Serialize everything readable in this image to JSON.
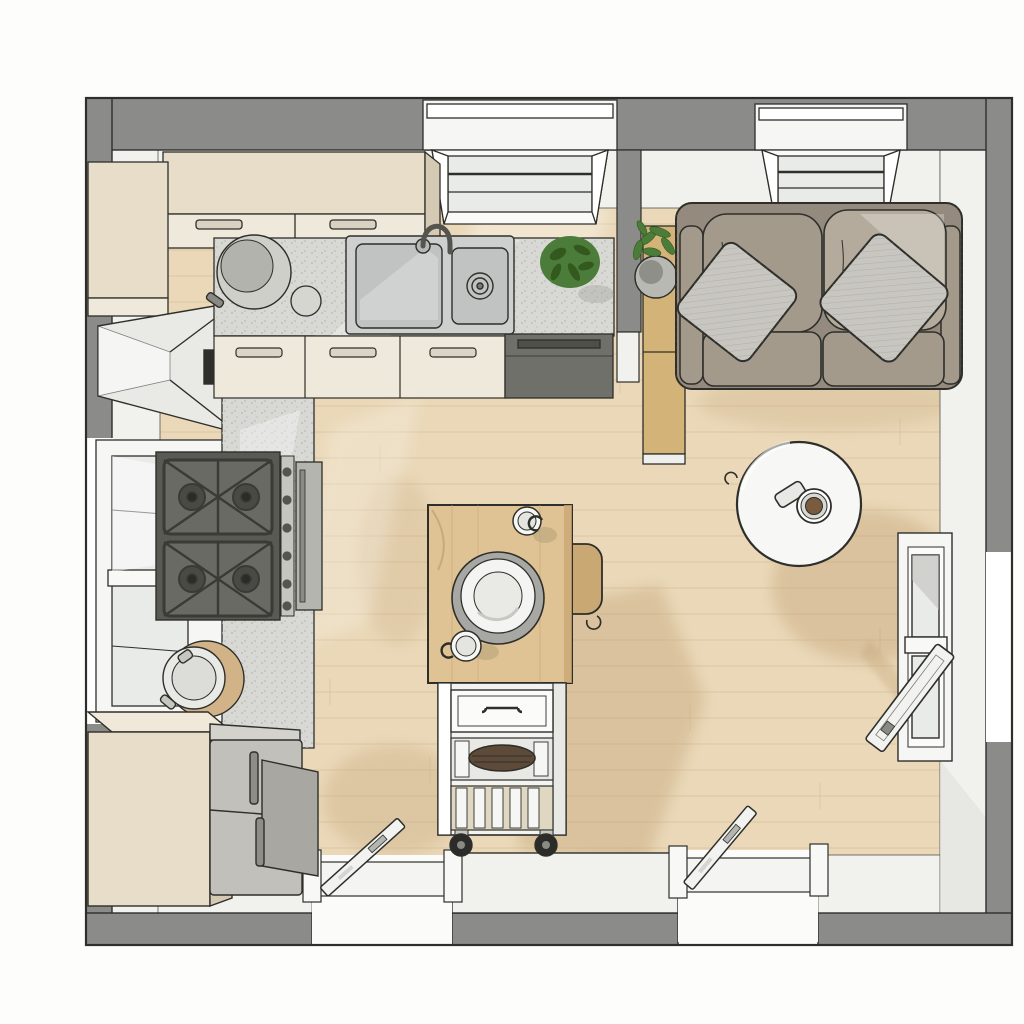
{
  "scene": {
    "type": "floor-plan",
    "view": "top-down-3d",
    "rooms": [
      "kitchen",
      "living-area"
    ],
    "counts": {
      "windows_top_wall": 2,
      "window_left_wall": 1,
      "right_wall_openings": 1,
      "bottom_doors": 2,
      "cooktop_burners": 4,
      "sofa_seats": 2,
      "throw_pillows": 2,
      "plants": 2
    },
    "furniture": [
      "upper-cabinets",
      "range-hood",
      "l-shaped-counter",
      "double-basin-sink",
      "faucet",
      "gas-cooktop",
      "oven",
      "dishwasher",
      "refrigerator",
      "base-wood-cabinet",
      "pot-on-cutting-board",
      "counter-pot",
      "counter-bowl",
      "counter-plant",
      "kitchen-island-cart",
      "island-drawer",
      "island-shelves",
      "caster-wheels",
      "dinner-plate",
      "coffee-cups",
      "bar-chair",
      "sofa",
      "throw-pillows",
      "side-table",
      "potted-plant",
      "round-coffee-table",
      "coffee-mug",
      "interior-doors",
      "windows",
      "partition-wall"
    ]
  },
  "colors": {
    "background": "#fdfdfb",
    "wall": "#8b8b89",
    "wall_face": "#f1f1ee",
    "wall_face_shade": "#e3e3e0",
    "outline": "#2e2e2a",
    "floor": "#ead8b8",
    "plank_line": "#d6bf9b",
    "floor_shadow": "#c3a478",
    "counter": "#d8d8d4",
    "cabinet_wood": "#e7ddc9",
    "cabinet_front": "#efe9db",
    "cabinet_side": "#d4c9b2",
    "hood": "#e9e9e5",
    "sink_steel": "#cdd0ce",
    "sink_basin": "#c0c3c1",
    "appliance_dark": "#70706a",
    "cooktop": "#5a5a54",
    "grate": "#3a3a36",
    "knob_panel": "#c6c6c1",
    "oven_door": "#b5b5b0",
    "fridge": "#c2c0ba",
    "fridge_side": "#a9a7a1",
    "island_top": "#dfc394",
    "island_edge": "#caa873",
    "cart_white": "#f3f3f1",
    "chair_wood": "#c9a873",
    "plate_rim": "#a7a7a3",
    "plate": "#f4f4f2",
    "bowl_dark": "#5d4a38",
    "wheel": "#2b2b29",
    "sofa_frame": "#948b7e",
    "sofa_cushion": "#a39a8c",
    "sofa_cushion_light": "#b4ab9c",
    "pillow": "#c8c6c0",
    "table_wood": "#d4b379",
    "plant_green": "#4c7c39",
    "plant_dark": "#33591f",
    "pot_gray": "#b9b9b4",
    "coffee_table": "#f7f7f5",
    "coffee": "#7b5b3e",
    "window_frame": "#f6f6f4",
    "window_pane": "#e9ebe9",
    "door_leaf": "#f2f2f0",
    "board_tan": "#d2b387"
  }
}
